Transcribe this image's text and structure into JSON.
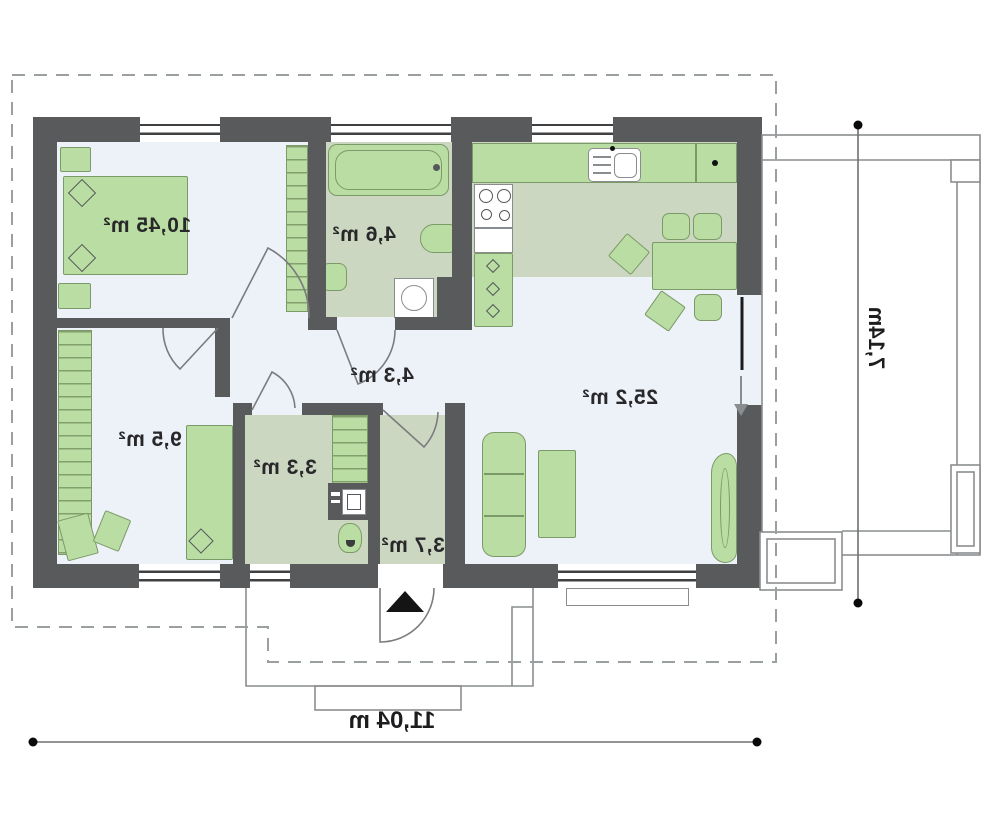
{
  "rooms": {
    "bedroom_main": {
      "area": "10,45 m²"
    },
    "bathroom": {
      "area": "4,6 m²"
    },
    "hallway": {
      "area": "4,3 m²"
    },
    "bedroom_second": {
      "area": "9,5 m²"
    },
    "storage": {
      "area": "3,3 m²"
    },
    "entry": {
      "area": "3,7 m²"
    },
    "living_room": {
      "area": "25,2 m²"
    }
  },
  "dimensions": {
    "total_width": "11,04 m",
    "total_depth": "7,14m"
  },
  "colors": {
    "wall": "#595a5c",
    "furniture_fill": "#b9dda2",
    "furniture_outline": "#7c9a68",
    "wet_room_floor": "#ccd7c2",
    "room_floor": "#edf1f8",
    "outline_gray": "#8a8d8f",
    "label_text": "#28282a",
    "entrance_marker": "#141414"
  },
  "icons": {
    "entrance_arrow": "entrance-arrow-icon",
    "terrace_exit_arrow": "terrace-exit-arrow-icon"
  }
}
